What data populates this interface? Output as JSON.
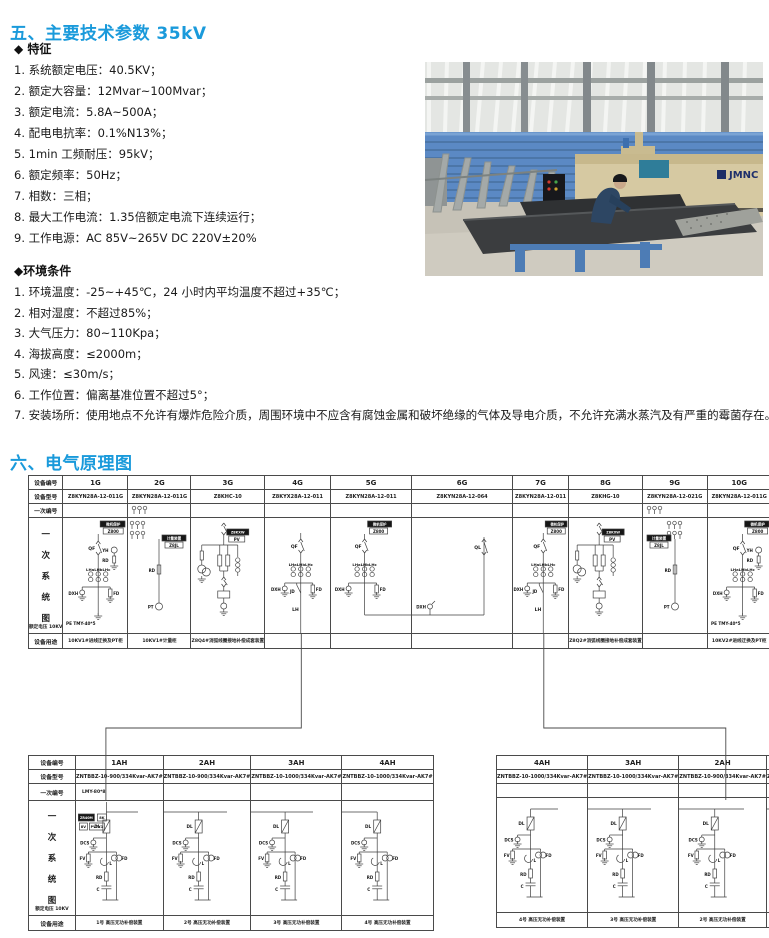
{
  "section5": {
    "title": "五、主要技术参数 35kV",
    "features_heading": "◆ 特征",
    "features": [
      "1. 系统额定电压：40.5KV；",
      "2. 额定大容量：12Mvar~100Mvar；",
      "3. 额定电流：5.8A~500A；",
      "4. 配电电抗率：0.1%N13%；",
      "5. 1min 工频耐压：95kV；",
      "6. 额定频率：50Hz；",
      "7. 相数：三相；",
      "8. 最大工作电流：1.35倍额定电流下连续运行；",
      "9. 工作电源：AC 85V~265V DC 220V±20%"
    ],
    "env_heading": "◆环境条件",
    "env": [
      "1. 环境温度：-25~+45℃，24 小时内平均温度不超过+35℃；",
      "2. 相对湿度：不超过85%；",
      "3. 大气压力：80~110Kpa；",
      "4. 海拔高度：≤2000m；",
      "5. 风速：≤30m/s；",
      "6. 工作位置：偏离基准位置不超过5°；",
      "7. 安装场所：使用地点不允许有爆炸危险介质，周围环境中不应含有腐蚀金属和破坏绝缘的气体及导电介质，不允许充满水蒸汽及有严重的霉菌存在。"
    ]
  },
  "photo": {
    "brand": "JMNC"
  },
  "section6": {
    "title": "六、电气原理图"
  },
  "colors": {
    "accent_blue": "#1a9adb",
    "line": "#3f3f3f",
    "photo_wall_blue": "#5b89c4",
    "machine_tan": "#d6c9a2"
  },
  "rowLabels": {
    "id": "设备编号",
    "model": "设备型号",
    "primary": "一次编号",
    "diagram": "一次系统图",
    "voltage": "额定电压 10KV",
    "purpose": "设备用途"
  },
  "topTable": {
    "headerW": 45,
    "columns": [
      {
        "id": "1G",
        "w": 65,
        "model": "Z8KYN28A-12-011G",
        "type": "incomer",
        "purpose": "10KV1#进线迂换及PT柜",
        "labels": {
          "box1": "微机保护",
          "box2": "Z800",
          "qf": "QF",
          "yh": "YH",
          "rd": "RD",
          "ct": "LHaLHbLHc",
          "dxh": "DXH",
          "fd": "FD",
          "pe": "PE TMY-40*5"
        }
      },
      {
        "id": "2G",
        "w": 63,
        "model": "Z8KYN28A-12-011G",
        "type": "metering",
        "row3": "fuses",
        "purpose": "10KV1#计量柜",
        "labels": {
          "box1": "计量装置",
          "box2": "Z8JL",
          "rd": "RD",
          "pt": "PT"
        }
      },
      {
        "id": "3G",
        "w": 64,
        "model": "Z8KHC-10",
        "type": "arcsupp",
        "purpose": "Z8Q4#消弧线圈接地补偿成套装置",
        "labels": {
          "box1": "Z8KXW",
          "box2": "PV"
        }
      },
      {
        "id": "4G",
        "w": 66,
        "model": "Z8KYX28A-12-011",
        "type": "feeder",
        "box": false,
        "purpose": "",
        "labels": {
          "qf": "QF",
          "ct": "LHaLHbLHc",
          "dxh": "DXH",
          "jd": "JD",
          "fd": "FD",
          "lh": "LH"
        }
      },
      {
        "id": "5G",
        "w": 81,
        "model": "Z8KYN28A-12-011",
        "type": "bustie",
        "purpose": "",
        "labels": {
          "box1": "微机保护",
          "box2": "Z800",
          "qf": "QF",
          "ct": "LHaLHbLHc",
          "dxh": "DXH",
          "fd": "FD"
        }
      },
      {
        "id": "6G",
        "w": 101,
        "model": "Z8KYN28A-12-064",
        "type": "ql",
        "purpose": "",
        "labels": {
          "ql": "QL",
          "dxh": "DXH"
        }
      },
      {
        "id": "7G",
        "w": 56,
        "model": "Z8KYN28A-12-011",
        "type": "feeder",
        "box": true,
        "purpose": "",
        "labels": {
          "box1": "微机保护",
          "box2": "Z800",
          "qf": "QF",
          "ct": "LHaLHbLHc",
          "dxh": "DXH",
          "jd": "JD",
          "fd": "FD",
          "lh": "LH"
        }
      },
      {
        "id": "8G",
        "w": 59,
        "model": "Z8KHG-10",
        "type": "arcsupp",
        "purpose": "Z8Q2#消弧线圈接地补偿成套装置",
        "labels": {
          "box1": "Z8KXW",
          "box2": "PV"
        }
      },
      {
        "id": "9G",
        "w": 65,
        "model": "Z8KYN28A-12-021G",
        "type": "metering",
        "mir": true,
        "row3": "fuses",
        "purpose": "",
        "labels": {
          "box1": "计量装置",
          "box2": "Z8JL",
          "rd": "RD",
          "pt": "PT"
        }
      },
      {
        "id": "10G",
        "w": 64,
        "model": "Z8KYN28A-12-011G",
        "type": "incomer",
        "purpose": "10KV2#进线迂换及PT柜",
        "labels": {
          "box1": "微机保护",
          "box2": "Z800",
          "qf": "QF",
          "yh": "YH",
          "rd": "RD",
          "ct": "LHaLHbLHc",
          "dxh": "DXH",
          "fd": "FD",
          "pe": "PE TMY-40*5"
        }
      }
    ]
  },
  "capLabels": {
    "dl": "DL",
    "dcs": "DCS",
    "fv": "FV",
    "fd": "FD",
    "l": "L",
    "rd": "RD",
    "c": "C",
    "b1": "ZR40M",
    "b2": "8K",
    "b3": "8V",
    "b4": "PVYY1"
  },
  "bottomLeft": {
    "headerW": 47,
    "columns": [
      {
        "id": "1AH",
        "w": 63,
        "model": "ZNTBBZ-10-900/334Kvar-AK7#",
        "primary": "LMY-80*8",
        "type": "capbank",
        "extra": true,
        "drop": true,
        "busL": false,
        "busR": true,
        "mxf": 0.49,
        "purpose": "1号 高压无功补偿装置"
      },
      {
        "id": "2AH",
        "w": 64,
        "model": "ZNTBBZ-10-900/334Kvar-AK7#",
        "primary": "",
        "type": "capbank",
        "busL": true,
        "busR": true,
        "purpose": "2号 高压无功补偿装置"
      },
      {
        "id": "3AH",
        "w": 63,
        "model": "ZNTBBZ-10-1000/334Kvar-AK7#",
        "primary": "",
        "type": "capbank",
        "busL": true,
        "busR": true,
        "purpose": "3号 高压无功补偿装置"
      },
      {
        "id": "4AH",
        "w": 65,
        "model": "ZNTBBZ-10-1000/334Kvar-AK7#",
        "primary": "",
        "type": "capbank",
        "busL": true,
        "busR": false,
        "purpose": "4号 高压无功补偿装置"
      }
    ]
  },
  "bottomRight": {
    "headerW": 0,
    "columns": [
      {
        "id": "4AH",
        "w": 62,
        "model": "ZNTBBZ-10-1000/334Kvar-AK7#",
        "primary": "",
        "type": "capbank",
        "busL": false,
        "busR": true,
        "purpose": "4号 高压无功补偿装置"
      },
      {
        "id": "3AH",
        "w": 64,
        "model": "ZNTBBZ-10-1000/334Kvar-AK7#",
        "primary": "",
        "type": "capbank",
        "busL": true,
        "busR": true,
        "purpose": "3号 高压无功补偿装置"
      },
      {
        "id": "2AH",
        "w": 66,
        "model": "ZNTBBZ-10-900/334Kvar-AK7#",
        "primary": "",
        "type": "capbank",
        "busL": true,
        "busR": true,
        "purpose": "2号 高压无功补偿装置"
      },
      {
        "id": "1AH",
        "w": 63,
        "model": "ZNTBBZ-10-300/600Kvar-AK7#",
        "primary": "LMY-80*8",
        "type": "capbank",
        "extra": true,
        "drop": true,
        "busL": true,
        "busR": false,
        "mxf": 0.6,
        "purpose": "1号 高压无功补偿装置"
      }
    ]
  }
}
